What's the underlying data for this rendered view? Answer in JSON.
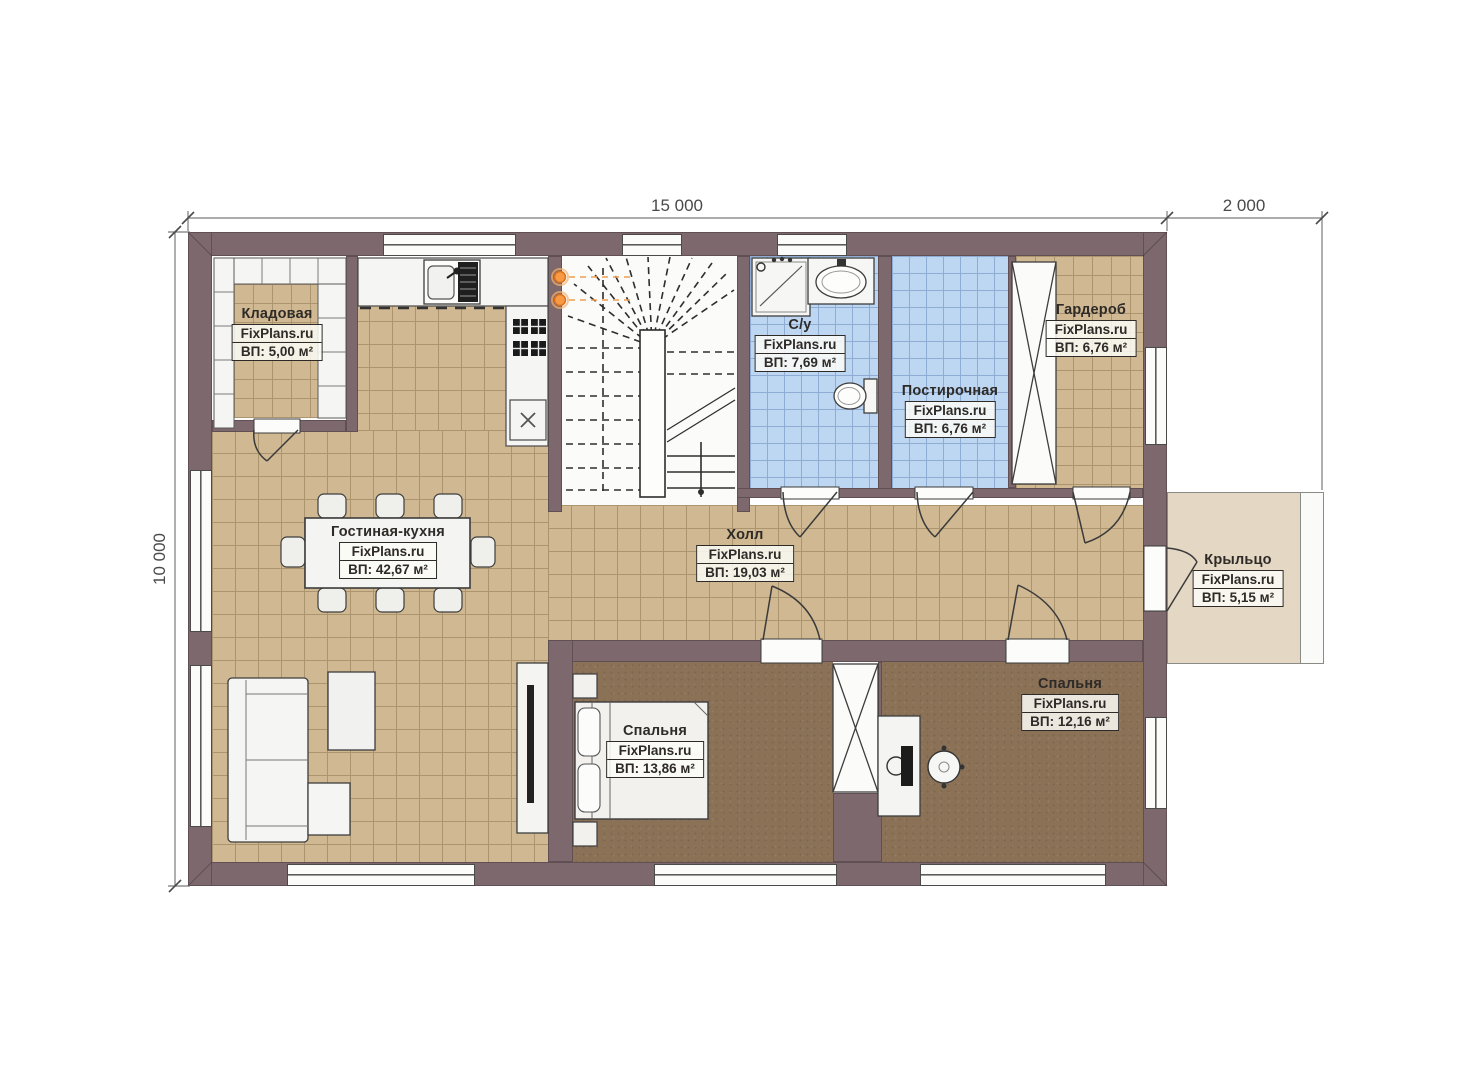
{
  "dimensions": {
    "top_main": "15 000",
    "top_porch": "2 000",
    "left_main": "10 000"
  },
  "rooms": [
    {
      "id": "kladovaya",
      "name": "Кладовая",
      "watermark": "FixPlans.ru",
      "area": "ВП: 5,00 м²"
    },
    {
      "id": "gostinaya-kuhnya",
      "name": "Гостиная-кухня",
      "watermark": "FixPlans.ru",
      "area": "ВП: 42,67 м²"
    },
    {
      "id": "holl",
      "name": "Холл",
      "watermark": "FixPlans.ru",
      "area": "ВП: 19,03 м²"
    },
    {
      "id": "sanuzel",
      "name": "С/у",
      "watermark": "FixPlans.ru",
      "area": "ВП: 7,69 м²"
    },
    {
      "id": "postirochnaya",
      "name": "Постирочная",
      "watermark": "FixPlans.ru",
      "area": "ВП: 6,76 м²"
    },
    {
      "id": "garderob",
      "name": "Гардероб",
      "watermark": "FixPlans.ru",
      "area": "ВП: 6,76 м²"
    },
    {
      "id": "kryltso",
      "name": "Крыльцо",
      "watermark": "FixPlans.ru",
      "area": "ВП: 5,15 м²"
    },
    {
      "id": "spalnya-1",
      "name": "Спальня",
      "watermark": "FixPlans.ru",
      "area": "ВП: 13,86 м²"
    },
    {
      "id": "spalnya-2",
      "name": "Спальня",
      "watermark": "FixPlans.ru",
      "area": "ВП: 12,16 м²"
    }
  ],
  "colors": {
    "wall": "#7d696d",
    "tile_tan": "#cfb892",
    "tile_tan_grout": "#ac946e",
    "tile_blue": "#bdd7f2",
    "tile_blue_grout": "#8fadd4",
    "carpet_brown": "#8b7257",
    "porch": "#e4d8c4",
    "fixture_white": "#f5f5f3",
    "lamp_accent": "#f79a43"
  }
}
